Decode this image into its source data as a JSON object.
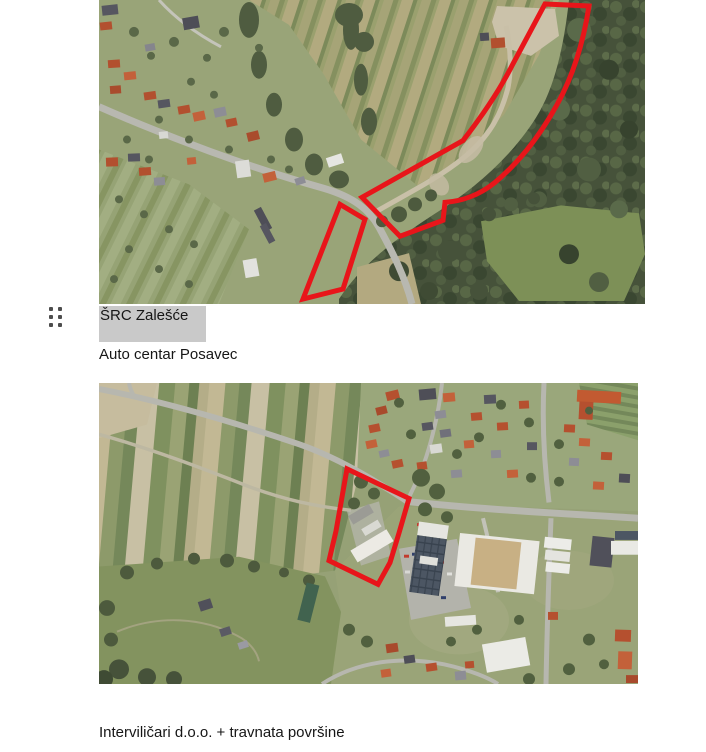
{
  "captions": {
    "caption1": "ŠRC Zalešće",
    "caption2": "Auto centar Posavec",
    "caption3": "Interviličari d.o.o. + travnata površine"
  },
  "highlight": {
    "color": "#c9c9c9"
  },
  "annotation": {
    "outline_color": "#e8151a"
  },
  "icons": {
    "drag_handle": "drag-handle-icon"
  },
  "images": [
    {
      "name": "aerial-image-1",
      "annotations": [
        "red-outline-band",
        "red-outline-parcel"
      ]
    },
    {
      "name": "aerial-image-2",
      "annotations": [
        "red-outline-parcel"
      ]
    }
  ]
}
